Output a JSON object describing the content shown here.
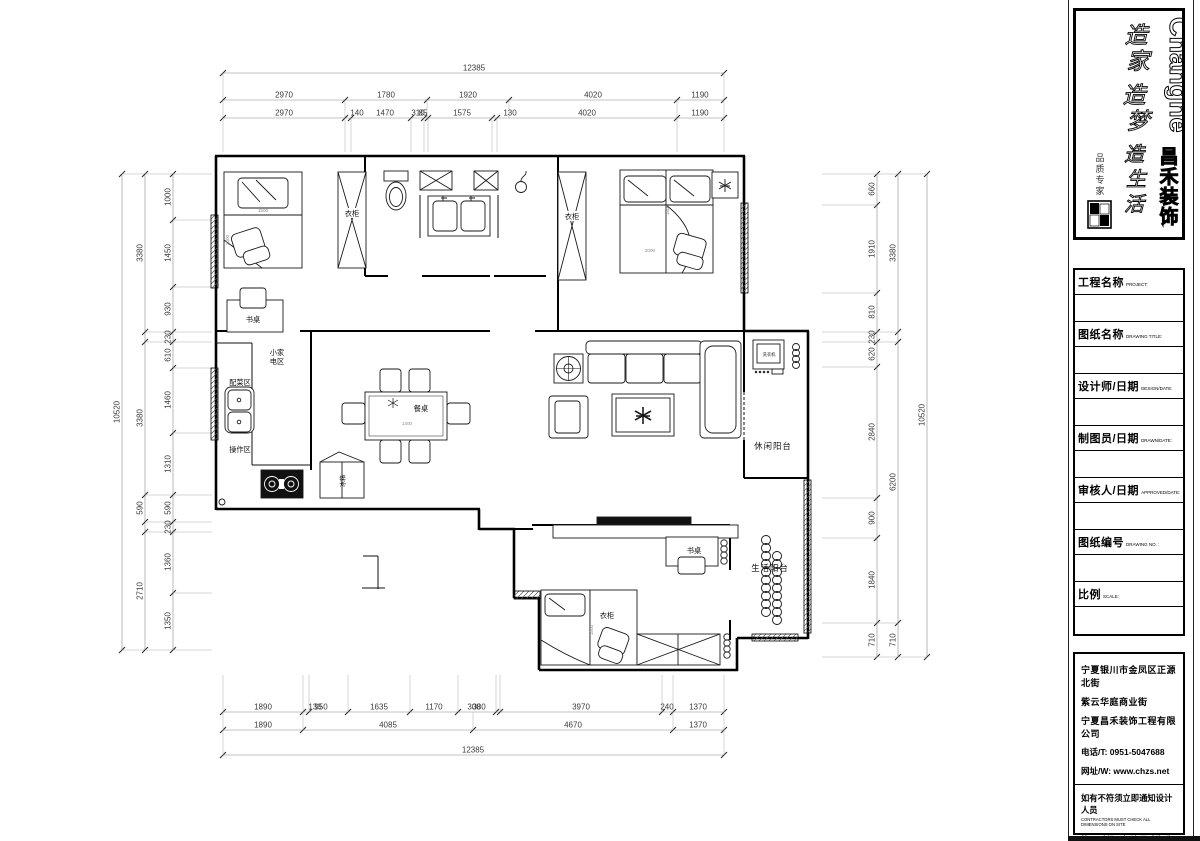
{
  "logo": {
    "brand_en": "Changhe",
    "brand_cn": "昌禾装饰",
    "slogan1": "造家",
    "slogan2": "造梦",
    "slogan3": "造生活",
    "signature": "品质专家"
  },
  "titleblock": {
    "rows": [
      {
        "cn": "工程名称",
        "en": "PROJECT:"
      },
      {
        "cn": "图纸名称",
        "en": "DRAWING TITLE:"
      },
      {
        "cn": "设计师/日期",
        "en": "DESIGN/DATE:"
      },
      {
        "cn": "制图员/日期",
        "en": "DRAWN/DATE:"
      },
      {
        "cn": "审核人/日期",
        "en": "APPROVED/DATE:"
      },
      {
        "cn": "图纸编号",
        "en": "DRAWING NO. :"
      },
      {
        "cn": "比例",
        "en": "SCALE:"
      }
    ]
  },
  "company": {
    "address1": "宁夏银川市金凤区正源北街",
    "address2": "紫云华庭商业街",
    "name": "宁夏昌禾装饰工程有限公司",
    "phone": "电话/T: 0951-5047688",
    "web": "网址/W: www.chzs.net",
    "notice1_cn": "如有不符须立即通知设计人员",
    "notice1_en": "CONTRACTORS MUST CHECK ALL DIMENSIONS ON SITE",
    "notice2_cn": "施工时须以标注尺寸为准",
    "notice2_en": "THIS DRAWING IS COPYRIGHT"
  },
  "plan": {
    "labels": {
      "wardrobe1": "衣柜",
      "wardrobe2": "衣柜",
      "wardrobe3": "衣柜",
      "desk1": "书桌",
      "desk2": "书桌",
      "dining": "餐桌",
      "dining_size": "1400",
      "kt_small1": "小家",
      "kt_small2": "电区",
      "kt_prep": "配菜区",
      "kt_work": "操作区",
      "fridge": "冰箱",
      "washer": "洗衣机",
      "balcony1": "休闲阳台",
      "balcony2": "生活阳台",
      "bed1_size": "1500",
      "bed2_w": "1800",
      "bed2_l": "2000",
      "bed3_size": "1500"
    }
  },
  "dims": {
    "top_total": [
      "12385"
    ],
    "top_row2": [
      "2970",
      "1780",
      "1920",
      "4020",
      "1190"
    ],
    "top_row3": [
      "2970",
      "140",
      "1470",
      "310",
      "85",
      "1575",
      "130",
      "4020",
      "1190"
    ],
    "bottom_row1": [
      "1890",
      "130",
      "950",
      "1635",
      "1170",
      "300",
      "380",
      "3970",
      "240",
      "1370"
    ],
    "bottom_row2": [
      "1890",
      "4085",
      "4670",
      "1370"
    ],
    "bottom_total": [
      "12385"
    ],
    "left_outer": [
      "10520"
    ],
    "left_mid": [
      "3380",
      "3380",
      "590",
      "2710"
    ],
    "left_inner": [
      "1000",
      "1450",
      "930",
      "230",
      "610",
      "1460",
      "1310",
      "590",
      "230",
      "1360",
      "1350"
    ],
    "right_inner": [
      "660",
      "1910",
      "810",
      "230",
      "620",
      "2840",
      "900",
      "1840",
      "710"
    ],
    "right_mid": [
      "3380",
      "6200",
      "710"
    ],
    "right_outer": [
      "10520"
    ]
  }
}
